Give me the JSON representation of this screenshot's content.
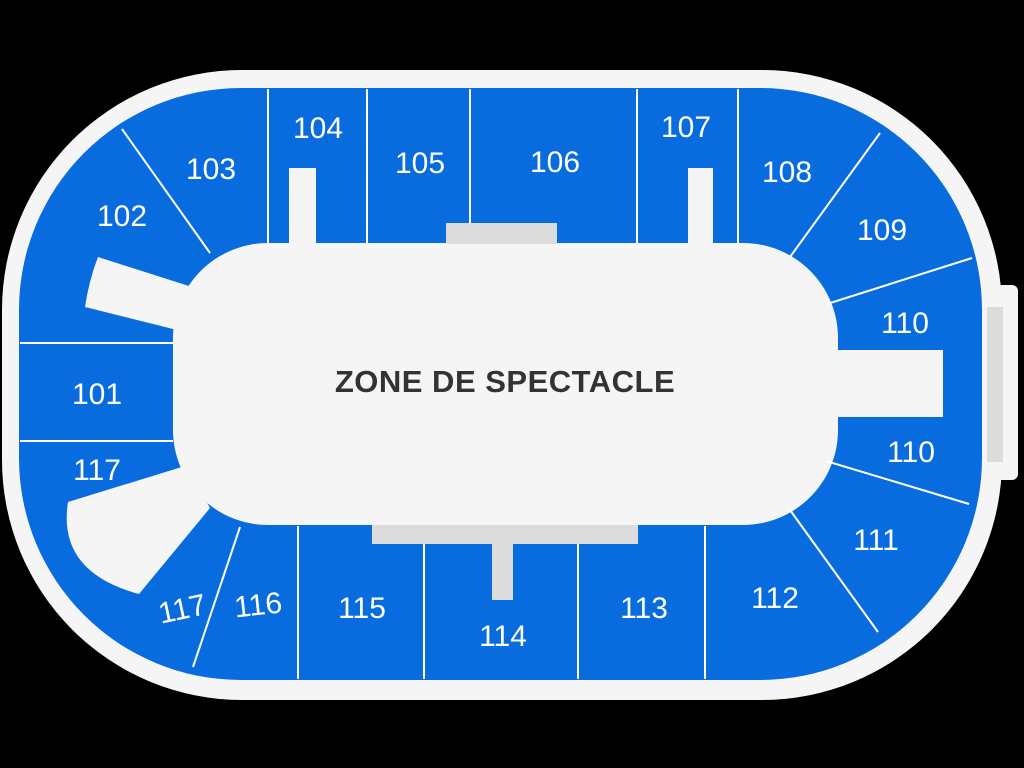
{
  "arena": {
    "floor_label": "ZONE DE SPECTACLE",
    "colors": {
      "background": "#000000",
      "plate": "#f5f5f5",
      "section_blue": "#086CDE",
      "stage_gray": "#dcdcdc",
      "divider_white": "#ffffff",
      "section_label": "#ffffff",
      "floor_label_color": "#333333"
    },
    "sections": [
      {
        "label": "101"
      },
      {
        "label": "102"
      },
      {
        "label": "103"
      },
      {
        "label": "104"
      },
      {
        "label": "105"
      },
      {
        "label": "106"
      },
      {
        "label": "107"
      },
      {
        "label": "108"
      },
      {
        "label": "109"
      },
      {
        "label": "110"
      },
      {
        "label": "110"
      },
      {
        "label": "111"
      },
      {
        "label": "112"
      },
      {
        "label": "113"
      },
      {
        "label": "114"
      },
      {
        "label": "115"
      },
      {
        "label": "116"
      },
      {
        "label": "117"
      },
      {
        "label": "117"
      }
    ]
  }
}
